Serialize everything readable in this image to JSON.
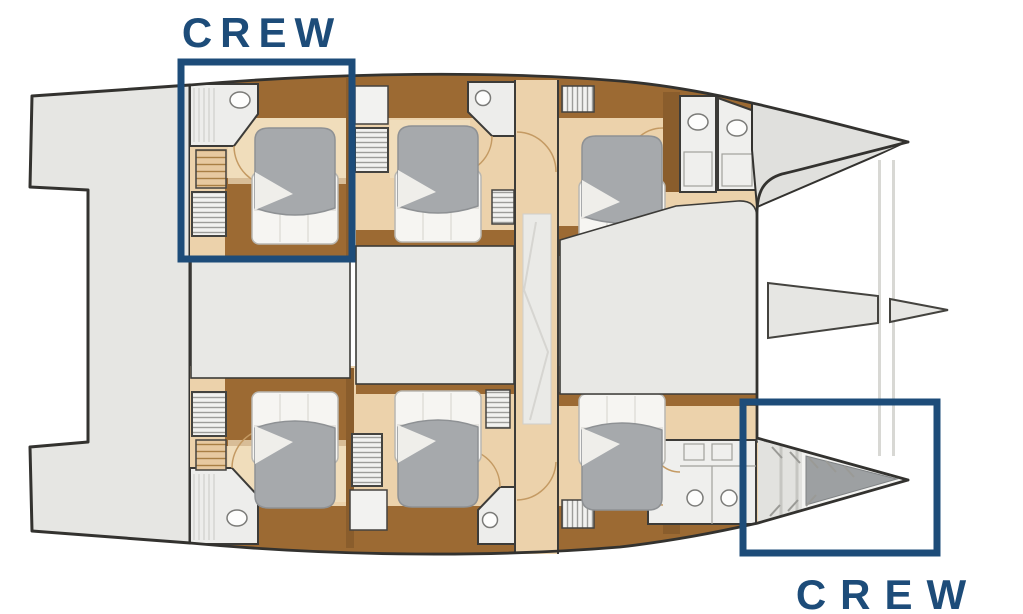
{
  "diagram": {
    "type": "catamaran-lower-deck-floor-plan",
    "annotations": {
      "crew_top": "CREW",
      "crew_bottom": "CREW"
    },
    "colors": {
      "accent_navy": "#1d4c79",
      "outline": "#33322f",
      "deck_gray": "#e8e8e5",
      "floor_tan": "#ecd2ab",
      "wood_brown": "#9c6a33",
      "bed_gray": "#a6a9ac",
      "bedding_white": "#f6f5f2"
    }
  }
}
